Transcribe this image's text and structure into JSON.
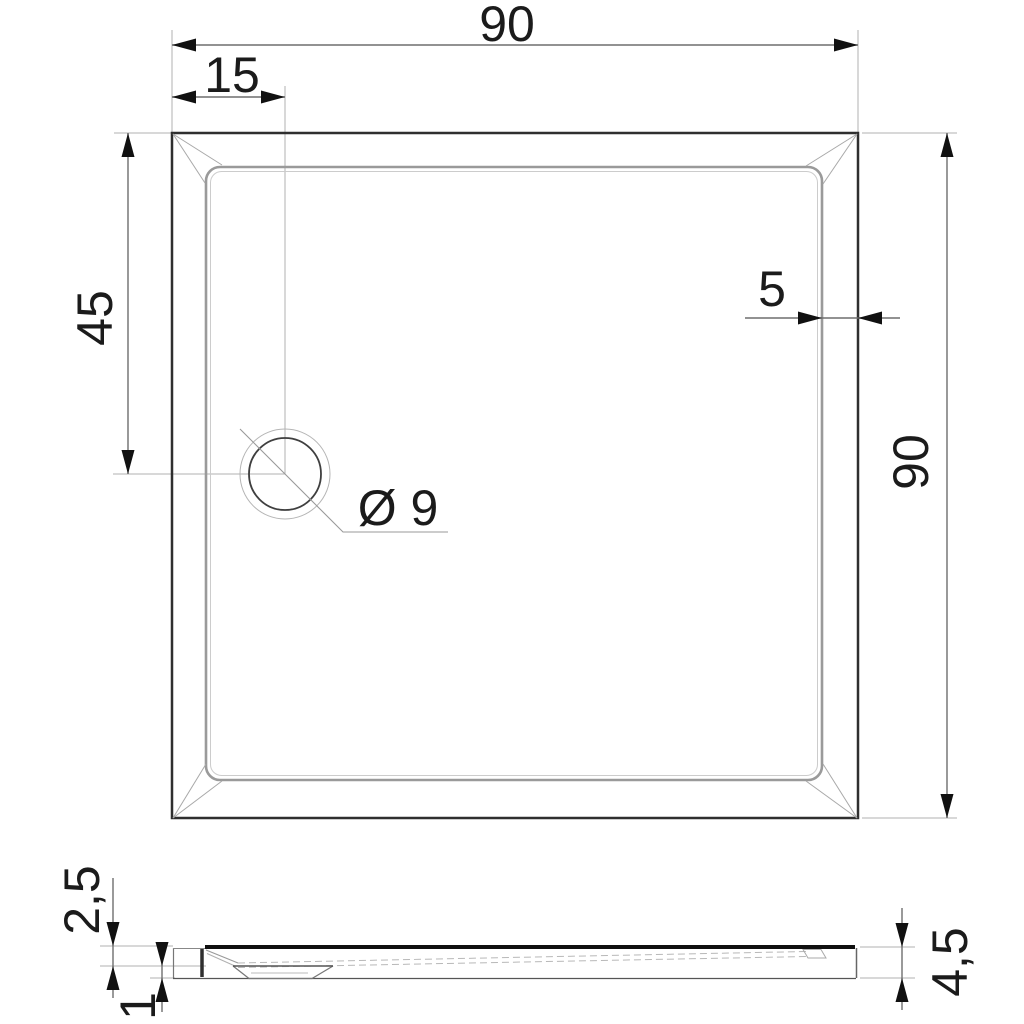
{
  "drawing": {
    "type": "technical-drawing",
    "subject": "square shower tray, plan view with drain and side section view",
    "views": {
      "plan": "top view of square tray with rounded-corner basin and offset drain",
      "section": "side section profile with drain boss"
    },
    "dims": {
      "overall_width": {
        "label": "90",
        "value": 90
      },
      "drain_offset_x": {
        "label": "15",
        "value": 15
      },
      "drain_offset_y": {
        "label": "45",
        "value": 45
      },
      "rim_width": {
        "label": "5",
        "value": 5
      },
      "overall_depth": {
        "label": "90",
        "value": 90
      },
      "drain_diameter": {
        "label": "Ø 9",
        "value": 9
      },
      "edge_height": {
        "label": "2,5",
        "value": 2.5
      },
      "bottom_height": {
        "label": "1",
        "value": 1
      },
      "total_height": {
        "label": "4,5",
        "value": 4.5
      }
    },
    "colors": {
      "background": "#ffffff",
      "outer_edge": "#2f2f2f",
      "rim_edge": "#9a9a9a",
      "basin_edge": "#cccccc",
      "dimension_line": "#6e6e6e",
      "extension_line": "#b0b0b0",
      "arrowhead": "#111111",
      "text": "#1b1b1b",
      "section_top_edge": "#101010"
    }
  }
}
